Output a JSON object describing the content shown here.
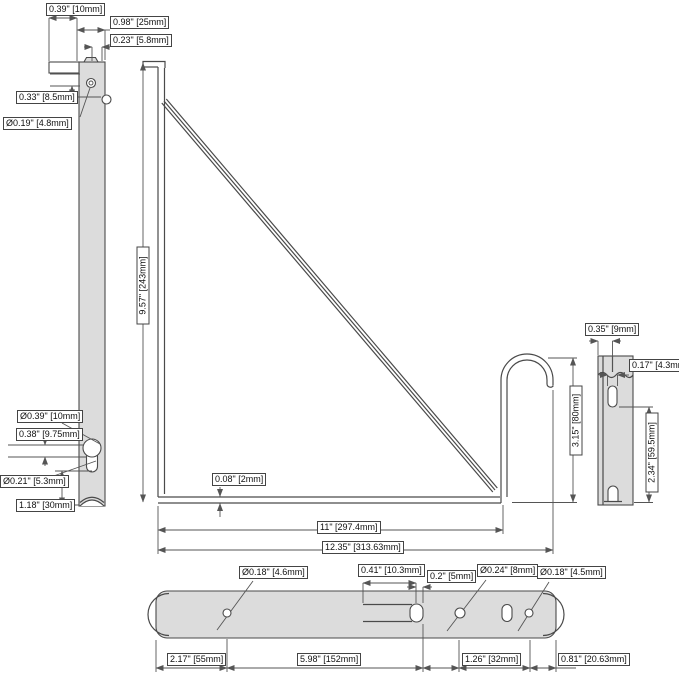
{
  "drawing": {
    "type": "technical-dimension-drawing",
    "part": "shelf bracket with hook and mounting bar",
    "views": [
      "front",
      "side",
      "bottom"
    ]
  },
  "colors": {
    "background": "#ffffff",
    "part_fill": "#dcdcdc",
    "line": "#4a4a4a",
    "dimension_line": "#555555",
    "label_border": "#444444",
    "label_text": "#111111"
  },
  "dims": {
    "tab_width": "0.39\" [10mm]",
    "top_width": "0.98\" [25mm]",
    "channel_width": "0.23\" [5.8mm]",
    "notch_offset": "0.33\" [8.5mm]",
    "top_hole_dia": "Ø0.19\" [4.8mm]",
    "bracket_height": "9.57\" [243mm]",
    "keyhole_dia": "Ø0.39\" [10mm]",
    "keyhole_pitch": "0.38\" [9.75mm]",
    "keyhole_slot_dia": "Ø0.21\" [5.3mm]",
    "keyhole_bottom_offset": "1.18\" [30mm]",
    "material_thickness": "0.08\" [2mm]",
    "inner_length": "11\" [297.4mm]",
    "total_length": "12.35\" [313.63mm]",
    "hook_height": "3.15\" [80mm]",
    "side_slot_offset": "0.35\" [9mm]",
    "side_slot_width": "0.17\" [4.3mm]",
    "side_lower_height": "2.34\" [59.5mm]",
    "bar_hole1_dia": "Ø0.18\" [4.6mm]",
    "bar_slot_length": "0.41\" [10.3mm]",
    "bar_slot_width": "0.2\" [5mm]",
    "bar_hole2_dia": "Ø0.24\" [8mm]",
    "bar_hole3_dia": "Ø0.18\" [4.5mm]",
    "bar_left_offset": "2.17\" [55mm]",
    "bar_mid_span": "5.98\" [152mm]",
    "bar_hole_span": "1.26\" [32mm]",
    "bar_right_offset": "0.81\" [20.63mm]"
  }
}
